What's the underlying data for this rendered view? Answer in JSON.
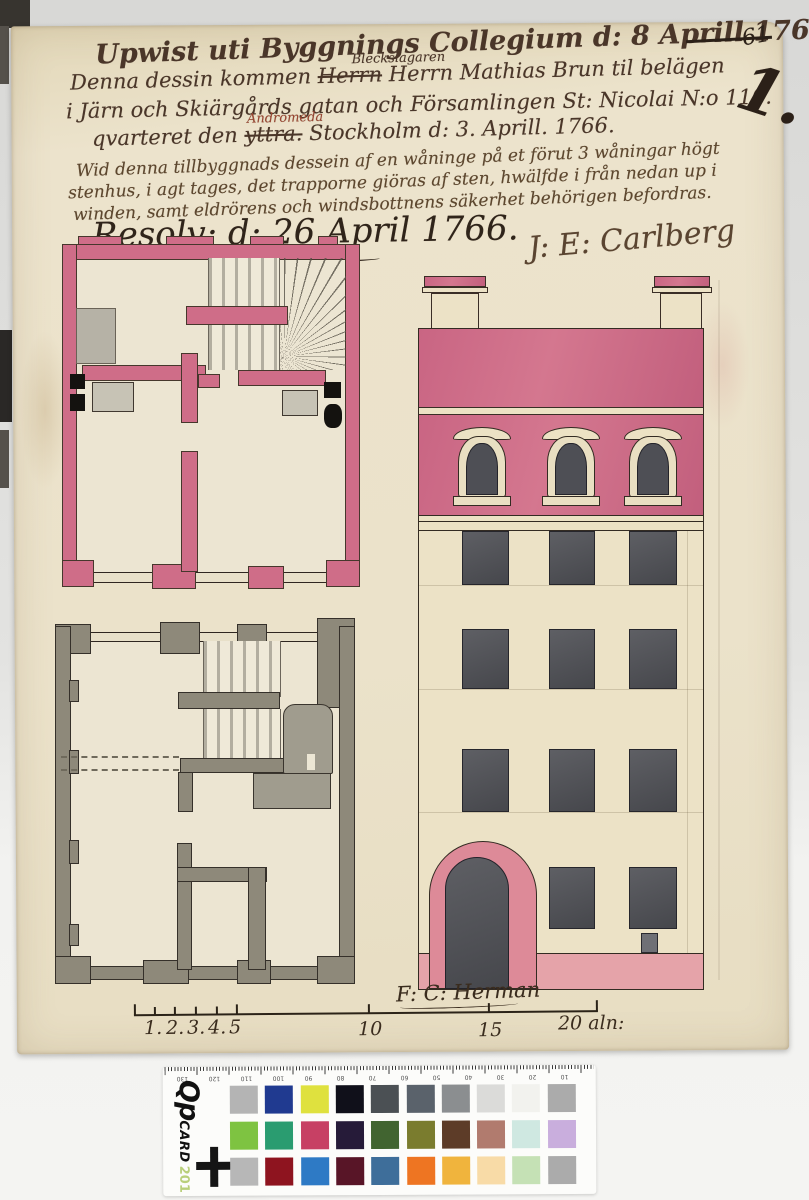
{
  "inscriptions": {
    "line1": "Upwist uti Byggnings Collegium d: 8 Aprill 1766. —",
    "line2_prefix": "Denna dessin kommen ",
    "line2_struck": "Herrn",
    "line2_insert": "Bleckslagaren",
    "line2_suffix": " Herrn Mathias Brun til belägen",
    "line3": "i Järn och Skiärgårds gatan och Församlingen St: Nicolai N:o 110.",
    "line4_prefix": "qvarteret den ",
    "line4_struck": "yttra.",
    "line4_insert": "Andromeda",
    "line4_suffix": " Stockholm d: 3. Aprill. 1766.",
    "note_lines": [
      "Wid denna tillbyggnads dessein af en wåninge på et förut 3 wåningar högt",
      "stenhus, i agt tages, det trapporne giöras af sten, hwälfde i från nedan up i",
      "winden, samt eldrörens och windsbottnens säkerhet behörigen befordras."
    ],
    "resolution": "Resolv: d: 26 April 1766.",
    "signature": "J: E: Carlberg",
    "facade_signature": "F: C: Herman",
    "folio_number": "1.",
    "corner_mark": "61"
  },
  "scale_bar": {
    "small_labels": [
      "1.",
      "2.",
      "3.",
      "4.",
      "5"
    ],
    "label_10": "10",
    "label_15": "15",
    "end_label": "20 aln:"
  },
  "qpcard": {
    "brand_qp": "Qp",
    "brand_card": "CARD",
    "brand_number": "201",
    "ruler_numbers": [
      "130",
      "120",
      "110",
      "100",
      "90",
      "80",
      "70",
      "60",
      "50",
      "40",
      "30",
      "20",
      "10"
    ],
    "patch_rows": [
      [
        "#b4b4b4",
        "#203a90",
        "#dfe13e",
        "#10101a",
        "#4b5054",
        "#5a626b",
        "#8b8e90",
        "#dbdbd9",
        "#f2f2ee",
        "#ababab"
      ],
      [
        "#7ec341",
        "#2a9c70",
        "#c74064",
        "#261b39",
        "#416430",
        "#7a7c2e",
        "#5d3c28",
        "#b17b6e",
        "#cfe8e1",
        "#c9aedd"
      ],
      [
        "#b7b7b7",
        "#8e141f",
        "#2e7ac5",
        "#581527",
        "#3e6e9a",
        "#ee7522",
        "#f0b43d",
        "#f8dba7",
        "#c5e1b5",
        "#ababab"
      ]
    ]
  },
  "palette": {
    "paper": "#ebe2ca",
    "plan_pink": "#cf6d88",
    "plan_gray": "#8e897a",
    "window_dark": "#4e4f55",
    "ink": "#4a3629",
    "insert_ink_red": "#9a4632"
  }
}
